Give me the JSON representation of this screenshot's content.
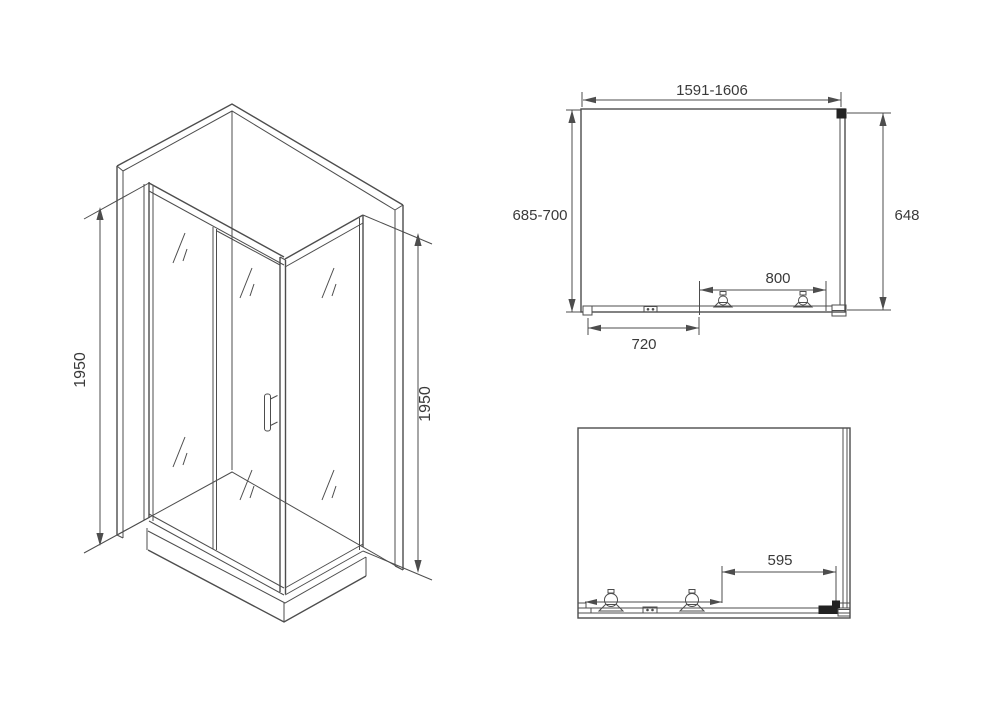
{
  "colors": {
    "line": "#4d4d4d",
    "text": "#3a3a3a",
    "background": "#ffffff"
  },
  "drawing": {
    "isometric_view": {
      "dim_height_left": "1950",
      "dim_height_right": "1950"
    },
    "plan_view": {
      "dim_width_range": "1591-1606",
      "dim_depth_range": "685-700",
      "dim_side_panel": "648",
      "dim_track": "800",
      "dim_fixed_panel": "720"
    },
    "front_view": {
      "dim_door_opening": "595"
    }
  }
}
